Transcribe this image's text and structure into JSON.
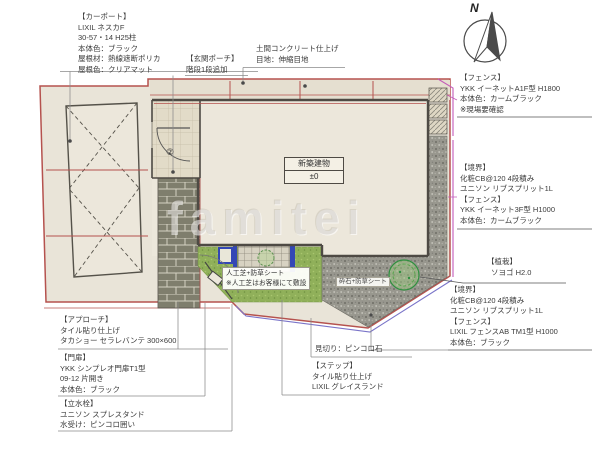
{
  "watermark": "famitei",
  "compass": {
    "label": "N"
  },
  "plan": {
    "building": {
      "name": "新築建物",
      "level": "±0"
    },
    "turf_note": {
      "line1": "人工芝+防草シート",
      "line2": "※人工芝はお客様にて敷設"
    },
    "gravel_note": {
      "line1": "砕石+防草シート"
    },
    "porch_number": "②"
  },
  "labels": {
    "carport": {
      "title": "【カーポート】",
      "lines": [
        "LIXIL ネスカF",
        "30-57・14 H25柱",
        "本体色：ブラック",
        "屋根材：熱線遮断ポリカ",
        "屋根色：クリアマット"
      ]
    },
    "porch": {
      "title": "【玄関ポーチ】",
      "lines": [
        "階段1段追加"
      ]
    },
    "concrete": {
      "lines": [
        "土間コンクリート仕上げ",
        "目地：伸縮目地"
      ]
    },
    "fence_ne": {
      "title": "【フェンス】",
      "lines": [
        "YKK イーネットA1F型  H1800",
        "本体色：カームブラック",
        "※現場要確認"
      ]
    },
    "boundary_e": {
      "title": "【境界】",
      "lines": [
        "化粧CB@120 4段積み",
        "ユニソン リブスプリット1L"
      ],
      "fence_title": "【フェンス】",
      "fence_lines": [
        "YKK イーネット3F型  H1000",
        "本体色：カームブラック"
      ]
    },
    "planting": {
      "title": "【植栽】",
      "lines": [
        "ソヨゴ  H2.0"
      ]
    },
    "boundary_s": {
      "title": "【境界】",
      "lines": [
        "化粧CB@120 4段積み",
        "ユニソン リブスプリット1L"
      ],
      "fence_title": "【フェンス】",
      "fence_lines": [
        "LIXIL フェンスAB TM1型  H1000",
        "本体色：ブラック"
      ]
    },
    "approach": {
      "title": "【アプローチ】",
      "lines": [
        "タイル貼り仕上げ",
        "タカショー セラレバンテ 300×600"
      ]
    },
    "gate": {
      "title": "【門扉】",
      "lines": [
        "YKK シンプレオ門扉T1型",
        "09-12 片開き",
        "本体色：ブラック"
      ]
    },
    "water_tap": {
      "title": "【立水栓】",
      "lines": [
        "ユニソン スプレスタンド",
        "水受け：ピンコロ囲い"
      ]
    },
    "edging": {
      "lines": [
        "見切り：ピンコロ石"
      ]
    },
    "step": {
      "title": "【ステップ】",
      "lines": [
        "タイル貼り仕上げ",
        "LIXIL グレイスランド"
      ]
    }
  },
  "colors": {
    "boundary_red": "#b5524e",
    "fence_magenta": "#c35ab8",
    "fence_blue": "#7a74c8",
    "turf_green": "#8fae58",
    "accent_blue": "#3347b5"
  }
}
